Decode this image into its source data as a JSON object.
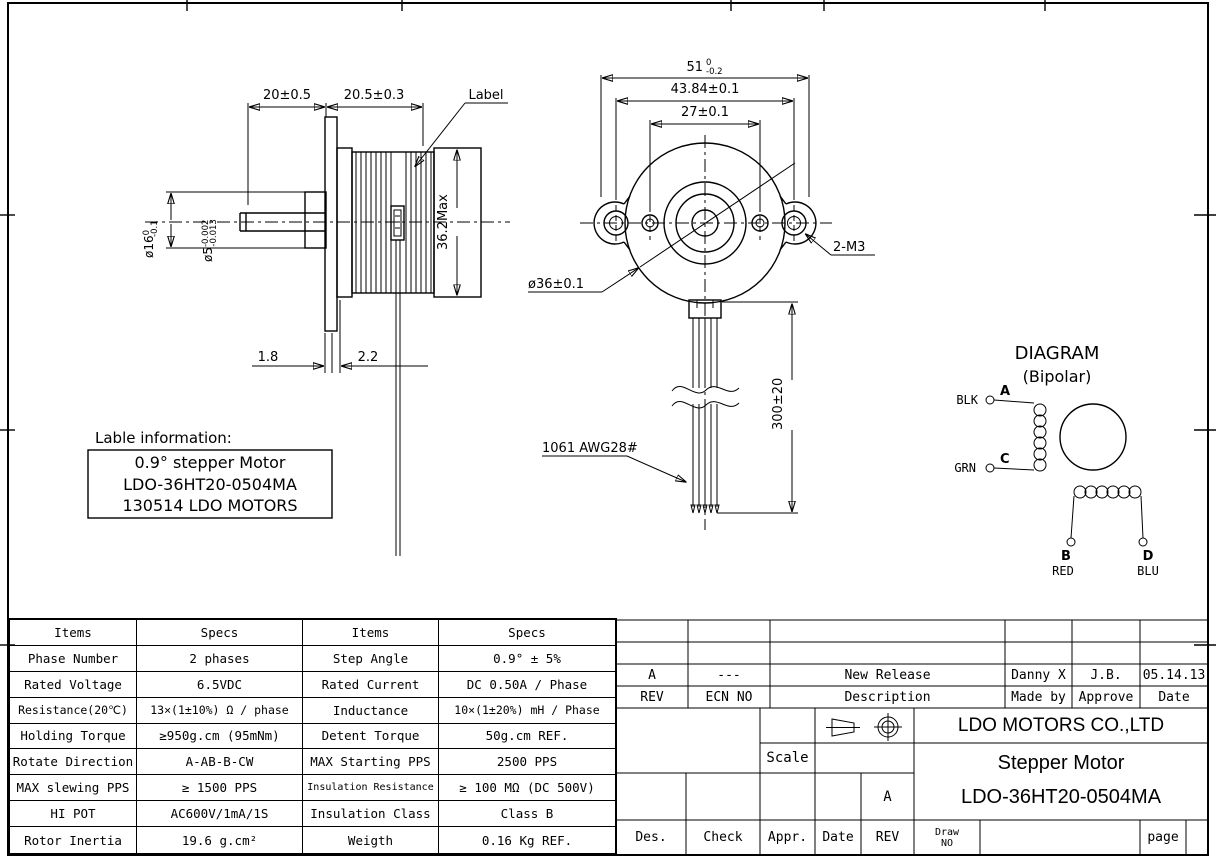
{
  "drawing": {
    "side": {
      "dim_shaft_len": "20±0.5",
      "dim_body_len": "20.5±0.3",
      "label_callout": "Label",
      "boss_dia": "ø16",
      "boss_tol_top": "0",
      "boss_tol_bot": "-0.1",
      "shaft_dia": "ø5",
      "shaft_tol_top": "-0.002",
      "shaft_tol_bot": "-0.013",
      "dim_height": "36.2Max",
      "dim_flange": "1.8",
      "dim_boss_len": "2.2",
      "info_heading": "Lable information:",
      "info_line1": "0.9° stepper Motor",
      "info_line2": "LDO-36HT20-0504MA",
      "info_line3": "130514 LDO MOTORS"
    },
    "front": {
      "dim_overall": "51",
      "dim_overall_tol_top": "0",
      "dim_overall_tol_bot": "-0.2",
      "dim_ear_span": "43.84±0.1",
      "dim_hole_span": "27±0.1",
      "dim_body_dia": "ø36±0.1",
      "screw_note": "2-M3",
      "dim_wire_len": "300±20",
      "wire_note": "1061 AWG28#"
    },
    "diagram": {
      "title": "DIAGRAM",
      "subtitle": "(Bipolar)",
      "term_a": "A",
      "term_b": "B",
      "term_c": "C",
      "term_d": "D",
      "wire_a": "BLK",
      "wire_b": "RED",
      "wire_c": "GRN",
      "wire_d": "BLU"
    }
  },
  "spec_table": {
    "rows": [
      [
        "Items",
        "Specs",
        "Items",
        "Specs"
      ],
      [
        "Phase Number",
        "2 phases",
        "Step Angle",
        "0.9° ± 5%"
      ],
      [
        "Rated Voltage",
        "6.5VDC",
        "Rated Current",
        "DC 0.50A / Phase"
      ],
      [
        "Resistance(20℃)",
        "13×(1±10%) Ω / phase",
        "Inductance",
        "10×(1±20%) mH / Phase"
      ],
      [
        "Holding Torque",
        "≥950g.cm (95mNm)",
        "Detent Torque",
        "50g.cm REF."
      ],
      [
        "Rotate Direction",
        "A-AB-B-CW",
        "MAX Starting PPS",
        "2500 PPS"
      ],
      [
        "MAX slewing PPS",
        "≥ 1500 PPS",
        "Insulation Resistance",
        "≥ 100 MΩ (DC 500V)"
      ],
      [
        "HI POT",
        "AC600V/1mA/1S",
        "Insulation Class",
        "Class B"
      ],
      [
        "Rotor Inertia",
        "19.6 g.cm²",
        "Weigth",
        "0.16 Kg  REF."
      ]
    ]
  },
  "title_block": {
    "rev_row": [
      "A",
      "---",
      "New Release",
      "Danny X",
      "J.B.",
      "05.14.13"
    ],
    "rev_header": [
      "REV",
      "ECN NO",
      "Description",
      "Made by",
      "Approve",
      "Date"
    ],
    "company": "LDO MOTORS CO.,LTD",
    "scale_label": "Scale",
    "size_rev": "A",
    "product": "Stepper Motor",
    "model": "LDO-36HT20-0504MA",
    "footer": [
      "Des.",
      "Check",
      "Appr.",
      "Date",
      "REV"
    ],
    "draw_no_line1": "Draw",
    "draw_no_line2": "NO",
    "page_label": "page"
  }
}
